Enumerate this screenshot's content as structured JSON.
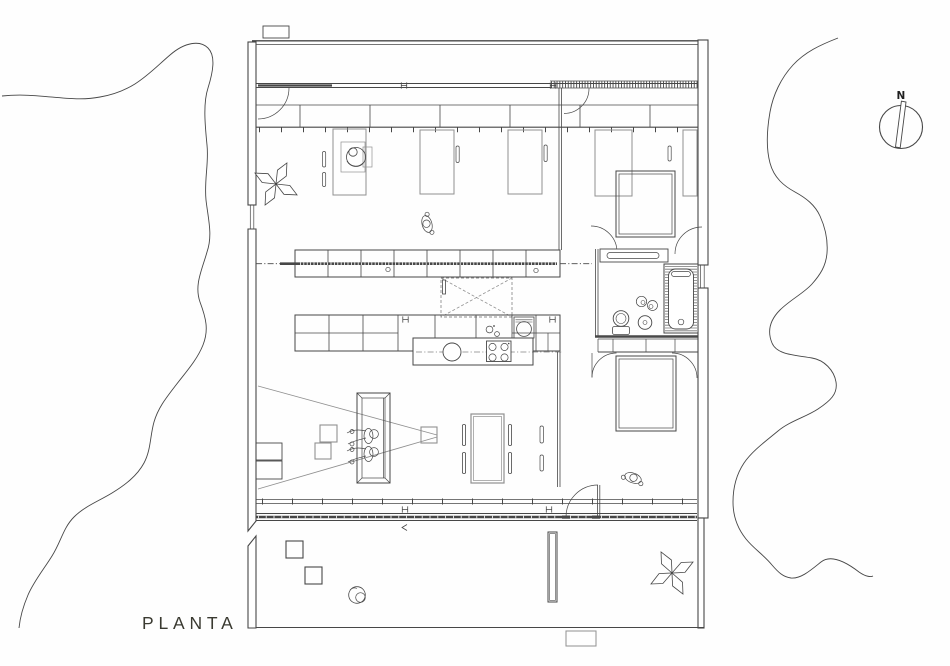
{
  "labels": {
    "title": "PLANTA",
    "compass_north": "N"
  },
  "colors": {
    "background": "#fefefe",
    "line_dark": "#474747",
    "line_light": "#909090",
    "wall_fill": "#ffffff",
    "text": "#3a3a31"
  },
  "drawing": {
    "type": "architectural-floor-plan",
    "depicted_symbols": [
      "site-contour-lines",
      "north-compass",
      "exterior-walls",
      "glazed-facades",
      "brise-soleil-hatch",
      "wardrobe-band",
      "desks",
      "office-chair-with-person",
      "butterfly-chairs",
      "shelving-rows",
      "kitchen-island-sink-stove",
      "overhead-dashed-skylight",
      "beds",
      "door-swing-arcs",
      "bathtub-hatched",
      "toilet",
      "washbasin",
      "sofa-with-two-people",
      "projection-cone",
      "dining-table-with-chairs",
      "terrace-stools",
      "planter",
      "walking-figures"
    ]
  }
}
